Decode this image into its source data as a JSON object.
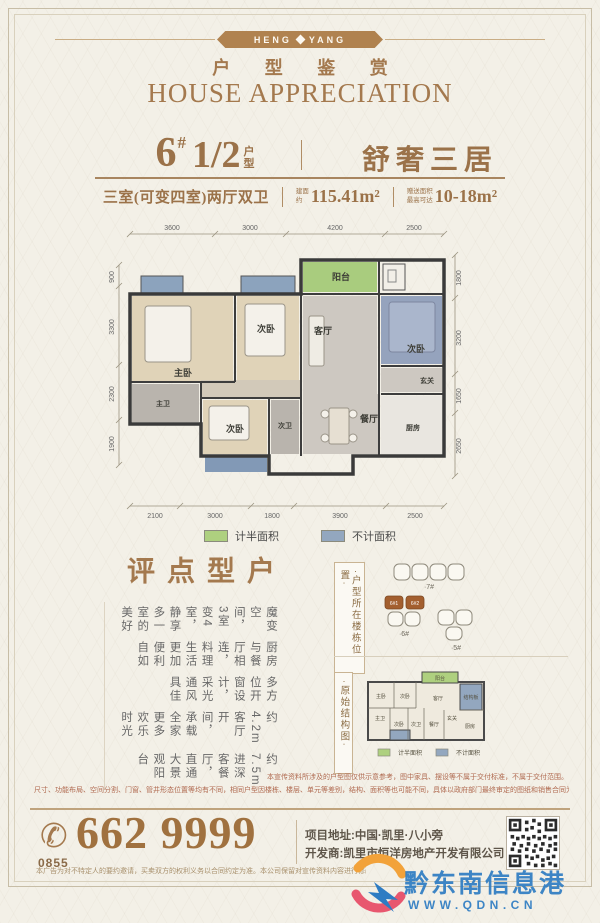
{
  "brand": {
    "badge_left": "HENG",
    "badge_right": "YANG",
    "title_cn": "户 型 鉴 赏",
    "title_en": "HOUSE APPRECIATION"
  },
  "unit": {
    "number": "6",
    "hash": "#",
    "fraction": "1/2",
    "fraction_suffix_top": "户",
    "fraction_suffix_bottom": "型",
    "name": "舒奢三居",
    "layout": "三室(可变四室)两厅双卫",
    "area_prefix_top": "建面",
    "area_prefix_bottom": "约",
    "area": "115.41m²",
    "bonus_prefix_top": "赠送面积",
    "bonus_prefix_bottom": "最高可达",
    "bonus": "10-18m²"
  },
  "floorplan": {
    "dims_top": [
      "3600",
      "3000",
      "4200",
      "2500"
    ],
    "dims_bottom": [
      "2100",
      "3000",
      "1800",
      "3900",
      "2500"
    ],
    "dims_left": [
      "900",
      "3300",
      "2300",
      "1900"
    ],
    "dims_right": [
      "1800",
      "3200",
      "1650",
      "2650"
    ],
    "rooms": [
      {
        "label": "主卧"
      },
      {
        "label": "次卧"
      },
      {
        "label": "阳台"
      },
      {
        "label": "客厅"
      },
      {
        "label": "次卧"
      },
      {
        "label": "玄关"
      },
      {
        "label": "餐厅"
      },
      {
        "label": "厨房"
      },
      {
        "label": "次卧"
      },
      {
        "label": "次卫"
      },
      {
        "label": "主卫"
      }
    ],
    "legend": [
      {
        "label": "计半面积",
        "color": "#aed07f"
      },
      {
        "label": "不计面积",
        "color": "#93a7bf"
      }
    ]
  },
  "review": {
    "title": "户型点评",
    "comments": [
      "魔变空间，3室变4室，静享多一室的美好",
      "厨房与餐厅相连，料理生活更加便利自如",
      "多方位开窗设计，采光通风具佳",
      "约4.2m客厅开间，承载全家更多欢乐时光",
      "约7.5m进深客餐厅，直通大景观阳台"
    ]
  },
  "location": {
    "label": "·户型所在楼栋位置·",
    "buildings": [
      "·7#",
      "·6#",
      "·5#"
    ],
    "highlight_units": [
      "6#1",
      "6#2"
    ]
  },
  "structure": {
    "label": "·原始结构图·",
    "rooms": [
      "主卧",
      "次卧",
      "客厅",
      "结构板",
      "主卫",
      "次卧",
      "次卫",
      "餐厅",
      "玄关",
      "厨房",
      "阳台"
    ],
    "legend": [
      {
        "label": "计半面积",
        "color": "#aed07f"
      },
      {
        "label": "不计面积",
        "color": "#93a7bf"
      }
    ]
  },
  "disclaimers": [
    "本宣传资料所涉及的户型图仅供示意参考，图中家具、摆设等不属于交付标准，不属于交付范围。",
    "尺寸、功能布局、空间分割、门窗、管井形态位置等均有不同，相同户型因楼栋、楼层、单元等差别，结构、面积等也可能不同，具体以政府部门最终审定的图纸和销售合同为准。"
  ],
  "contact": {
    "area_code": "0855",
    "phone": "662 9999",
    "address": "项目地址:中国·凯里·八小旁",
    "developer": "开发商:凯里市恒洋房地产开发有限公司",
    "fine_print": "本广告为对不特定人的要约邀请，买卖双方的权利义务以合同约定为准。本公司保留对宣传资料内容进行修改的权利，敬请留意最新资料。"
  },
  "watermark": {
    "name": "黔东南信息港",
    "url": "WWW.QDN.CN"
  }
}
